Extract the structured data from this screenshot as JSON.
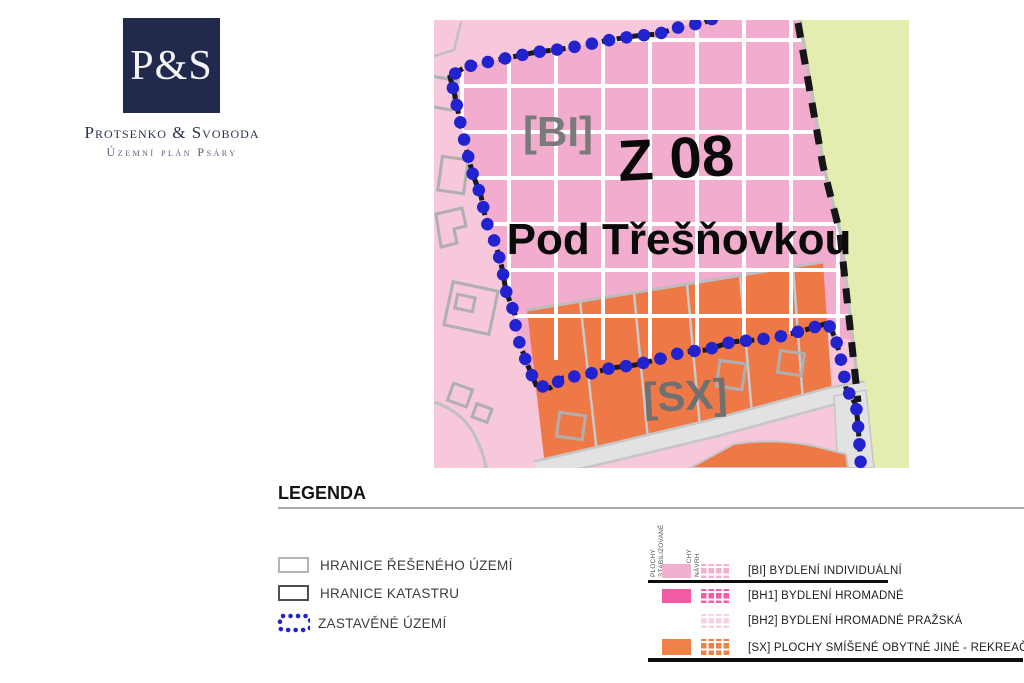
{
  "logo": {
    "monogram": "P&S",
    "company": "Protsenko & Svoboda",
    "subtitle": "Územní plán Psáry"
  },
  "map": {
    "zone_code": "Z 08",
    "zone_name": "Pod Třešňovkou",
    "region_bi_label": "[BI]",
    "region_sx_label": "[SX]"
  },
  "legend": {
    "title": "LEGENDA",
    "line_items": [
      {
        "label": "HRANICE ŘEŠENÉHO ÚZEMÍ"
      },
      {
        "label": "HRANICE KATASTRU"
      },
      {
        "label": "ZASTAVĚNÉ ÚZEMÍ"
      }
    ],
    "columns": [
      {
        "line1": "PLOCHY",
        "line2": "STABILIZOVANÉ"
      },
      {
        "line1": "PLOCHY",
        "line2": "NÁVRH"
      }
    ],
    "area_items": [
      {
        "label": "[BI] BYDLENÍ INDIVIDUÁLNÍ",
        "color": "#f2b0d1"
      },
      {
        "label": "[BH1] BYDLENÍ HROMADNÉ",
        "color": "#f25ca4"
      },
      {
        "label": "[BH2] BYDLENÍ HROMADNÉ PRAŽSKÁ",
        "color": "#f8d3e6"
      },
      {
        "label": "[SX] PLOCHY SMÍŠENÉ OBYTNÉ JINÉ - REKREAČNÍ",
        "color": "#f08045"
      }
    ]
  },
  "colors": {
    "logo_navy": "#212a4d",
    "map_pink_base": "#f7c7dc",
    "map_pink_zone": "#f2acce",
    "map_orange": "#ef7847",
    "map_green": "#e4ecb0",
    "map_road_gray": "#e2e2e2",
    "boundary_blue": "#2322cf",
    "label_gray": "#707070"
  }
}
